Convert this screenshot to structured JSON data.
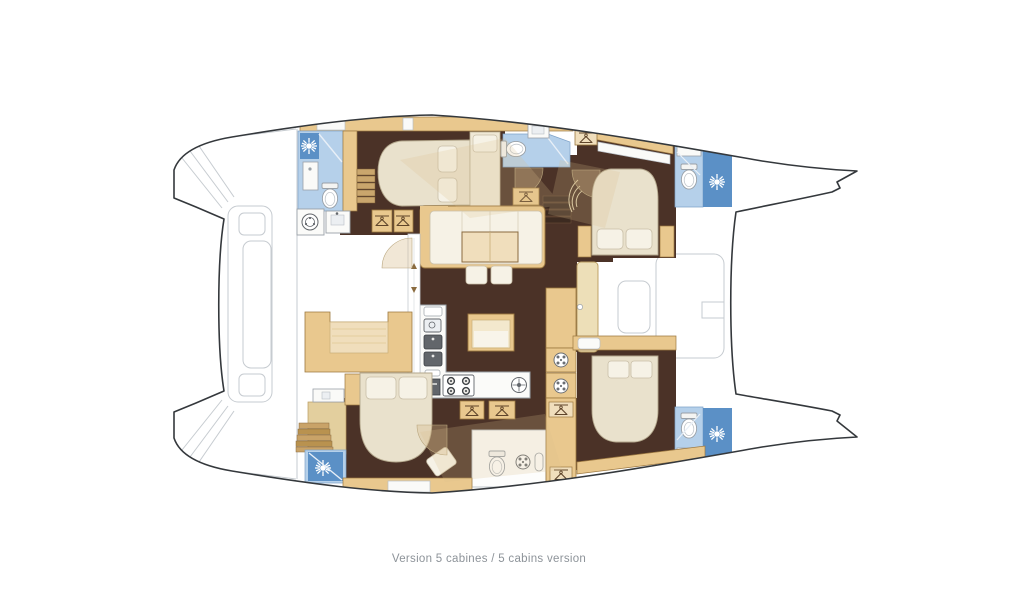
{
  "caption": {
    "text": "Version 5 cabines / 5 cabins version"
  },
  "palette": {
    "hull_outline": "#34383c",
    "deck_line": "#c6cbd0",
    "deck_line_soft": "#a9b0b7",
    "floor_dark": "#4b3227",
    "floor_dark2": "#3c2a20",
    "wood": "#e9c88e",
    "wood_border": "#9c7840",
    "wood_light": "#f0debc",
    "wood_pale": "#f3e8cd",
    "cream_panel": "#efe8d6",
    "bed_fill": "#e9e1cc",
    "bed_stroke": "#b3a78c",
    "pillow": "#f6f2e6",
    "blue_light": "#b5d0ea",
    "blue_mid": "#93b9de",
    "blue_dark": "#5b90c6",
    "counter_fill": "#fbfbf9",
    "counter_stroke": "#9aa1a8",
    "steel": "#62666b",
    "icon_stroke": "#5f452a",
    "caption_color": "#8d9399",
    "shadow_tint": "rgba(214,186,138,0.35)"
  },
  "icons": {
    "shower": "sunburst",
    "toilet": "bowl-with-tank",
    "sink": "basin-with-faucet",
    "wardrobe": "clothes-hanger",
    "vent": "round-vent-grille",
    "stove": "four-burners",
    "oven": "oven-door",
    "washer": "porthole-drum",
    "door": "quarter-arc-swing"
  }
}
